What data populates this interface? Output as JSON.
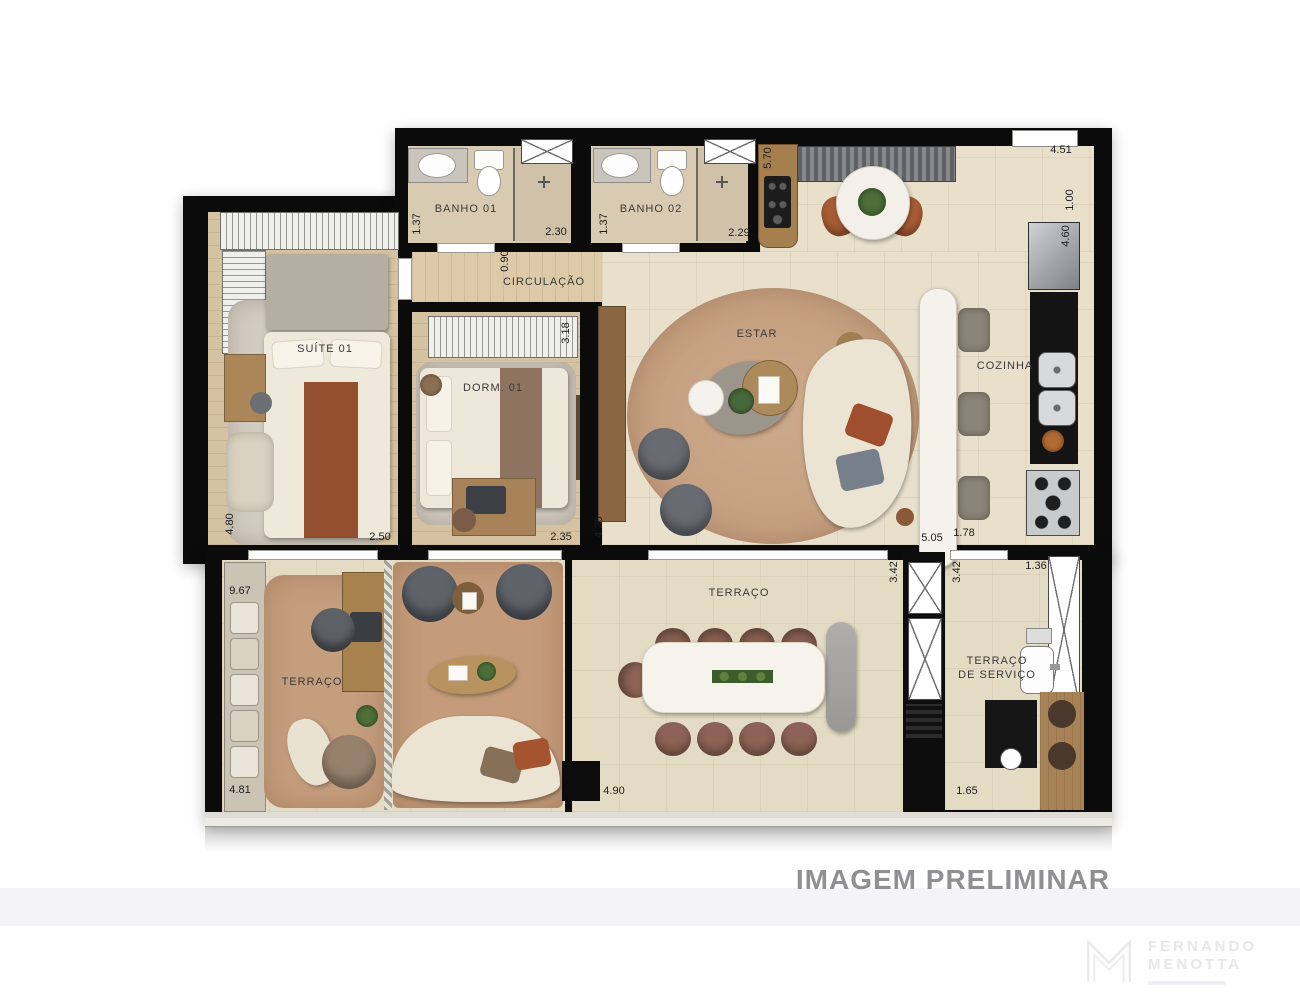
{
  "watermark": "IMAGEM PRELIMINAR",
  "logo": {
    "name_line1": "FERNANDO",
    "name_line2": "MENOTTA"
  },
  "rooms": {
    "banho01": {
      "label": "BANHO 01"
    },
    "banho02": {
      "label": "BANHO 02"
    },
    "circulacao": {
      "label": "CIRCULAÇÃO"
    },
    "suite01": {
      "label": "SUÍTE 01"
    },
    "dorm01": {
      "label": "DORM. 01"
    },
    "estar": {
      "label": "ESTAR"
    },
    "cozinha": {
      "label": "COZINHA"
    },
    "terraco_lateral": {
      "label": "TERRAÇO"
    },
    "terraco": {
      "label": "TERRAÇO"
    },
    "terraco_servico": {
      "label_line1": "TERRAÇO",
      "label_line2": "DE SERVIÇO"
    }
  },
  "dimensions": [
    {
      "value": "1.37",
      "x": 417,
      "y": 224,
      "orientation": "v"
    },
    {
      "value": "2.30",
      "x": 556,
      "y": 232,
      "orientation": "h"
    },
    {
      "value": "1.37",
      "x": 604,
      "y": 224,
      "orientation": "v"
    },
    {
      "value": "2.29",
      "x": 739,
      "y": 233,
      "orientation": "h"
    },
    {
      "value": "0.90",
      "x": 505,
      "y": 261,
      "orientation": "v"
    },
    {
      "value": "5.70",
      "x": 768,
      "y": 158,
      "orientation": "v"
    },
    {
      "value": "4.51",
      "x": 1061,
      "y": 150,
      "orientation": "h"
    },
    {
      "value": "1.00",
      "x": 1070,
      "y": 200,
      "orientation": "v"
    },
    {
      "value": "4.60",
      "x": 1066,
      "y": 236,
      "orientation": "v"
    },
    {
      "value": "3.18",
      "x": 566,
      "y": 333,
      "orientation": "v"
    },
    {
      "value": "4.80",
      "x": 230,
      "y": 524,
      "orientation": "v"
    },
    {
      "value": "2.50",
      "x": 380,
      "y": 537,
      "orientation": "h"
    },
    {
      "value": "2.35",
      "x": 561,
      "y": 537,
      "orientation": "h"
    },
    {
      "value": "4.20",
      "x": 599,
      "y": 527,
      "orientation": "v"
    },
    {
      "value": "5.05",
      "x": 932,
      "y": 538,
      "orientation": "h"
    },
    {
      "value": "1.78",
      "x": 964,
      "y": 533,
      "orientation": "h"
    },
    {
      "value": "3.42",
      "x": 894,
      "y": 572,
      "orientation": "v"
    },
    {
      "value": "3.42",
      "x": 957,
      "y": 572,
      "orientation": "v"
    },
    {
      "value": "1.36",
      "x": 1036,
      "y": 566,
      "orientation": "h"
    },
    {
      "value": "9.67",
      "x": 240,
      "y": 591,
      "orientation": "h"
    },
    {
      "value": "4.81",
      "x": 240,
      "y": 790,
      "orientation": "h"
    },
    {
      "value": "4.90",
      "x": 614,
      "y": 791,
      "orientation": "h"
    },
    {
      "value": "1.65",
      "x": 967,
      "y": 791,
      "orientation": "h"
    }
  ],
  "colors": {
    "wall": "#0b0b0b",
    "floor_tile": "#e8e0cb",
    "floor_wood": "#d5c2a0",
    "terrace_tile": "#e4dbc4",
    "rug_terracotta": "#c7a184",
    "sofa_cream": "#ebe4d3",
    "accent_rust": "#9f4f2d",
    "marble": "#f5f2eb",
    "counter_black": "#141414",
    "watermark_gray": "#8f8f94"
  }
}
